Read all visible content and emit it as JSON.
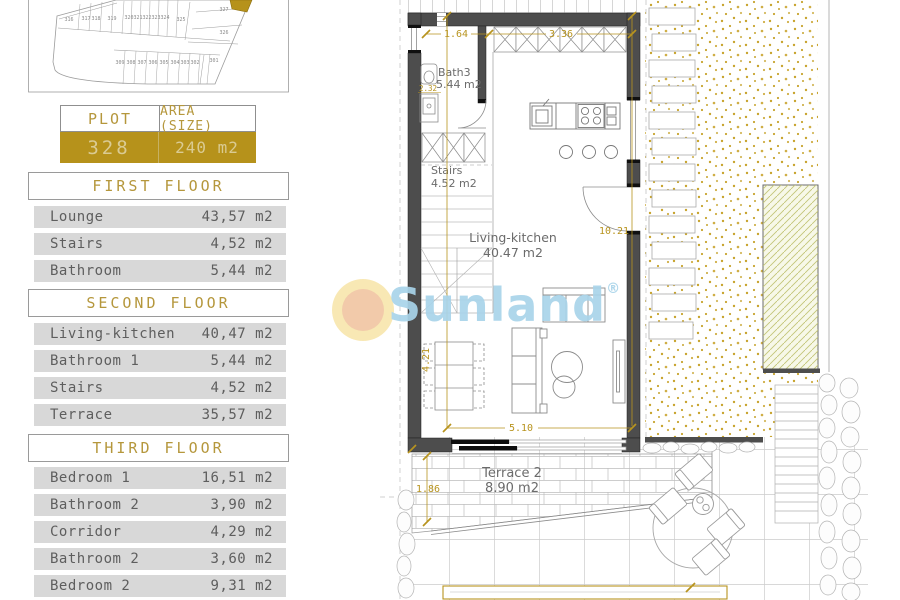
{
  "plot_table": {
    "plot_label": "PLOT",
    "area_label": "AREA (SIZE)",
    "plot_value": "328",
    "area_value": "240 m2"
  },
  "sections": [
    {
      "title": "FIRST FLOOR",
      "rows": [
        {
          "name": "Lounge",
          "area": "43,57 m2"
        },
        {
          "name": "Stairs",
          "area": "4,52 m2"
        },
        {
          "name": "Bathroom",
          "area": "5,44 m2"
        }
      ]
    },
    {
      "title": "SECOND FLOOR",
      "rows": [
        {
          "name": "Living-kitchen",
          "area": "40,47 m2"
        },
        {
          "name": "Bathroom 1",
          "area": "5,44 m2"
        },
        {
          "name": "Stairs",
          "area": "4,52 m2"
        },
        {
          "name": "Terrace",
          "area": "35,57 m2"
        }
      ]
    },
    {
      "title": "THIRD FLOOR",
      "rows": [
        {
          "name": "Bedroom 1",
          "area": "16,51 m2"
        },
        {
          "name": "Bathroom 2",
          "area": "3,90 m2"
        },
        {
          "name": "Corridor",
          "area": "4,29 m2"
        },
        {
          "name": "Bathroom 2",
          "area": "3,60 m2"
        },
        {
          "name": "Bedroom 2",
          "area": "9,31 m2"
        }
      ]
    }
  ],
  "site_plan": {
    "highlighted_plot": "328",
    "top_row": [
      "316",
      "317",
      "318",
      "319",
      "320",
      "321",
      "322",
      "323",
      "324",
      "325"
    ],
    "right_column": [
      "327",
      "326"
    ],
    "bottom_row": [
      "309",
      "308",
      "307",
      "306",
      "305",
      "304",
      "303",
      "302",
      "301"
    ]
  },
  "plan": {
    "rooms": {
      "bath": {
        "name": "Bath3",
        "area": "5.44 m2"
      },
      "stairs": {
        "name": "Stairs",
        "area": "4.52 m2"
      },
      "living": {
        "name": "Living-kitchen",
        "area": "40.47 m2"
      },
      "terrace": {
        "name": "Terrace 2",
        "area": "8.90 m2"
      }
    },
    "dimensions": {
      "top_left": "1.64",
      "top_right": "3.36",
      "right": "10.21",
      "left_mid": "4.21",
      "bottom": "5.10",
      "terrace_left": "1.86",
      "bath": "2.32"
    }
  },
  "watermark": {
    "text": "Sunland",
    "reg": "®"
  },
  "colors": {
    "gold": "#b6921b",
    "gold_text": "#b5973c",
    "dim_gold": "#b8941f",
    "row_gray": "#d8d8d8",
    "wall_gray": "#4d4d4d",
    "watermark_blue": "#a9d4ea",
    "gravel_gold": "#c7a42e",
    "hatch_green": "#c3c577"
  }
}
